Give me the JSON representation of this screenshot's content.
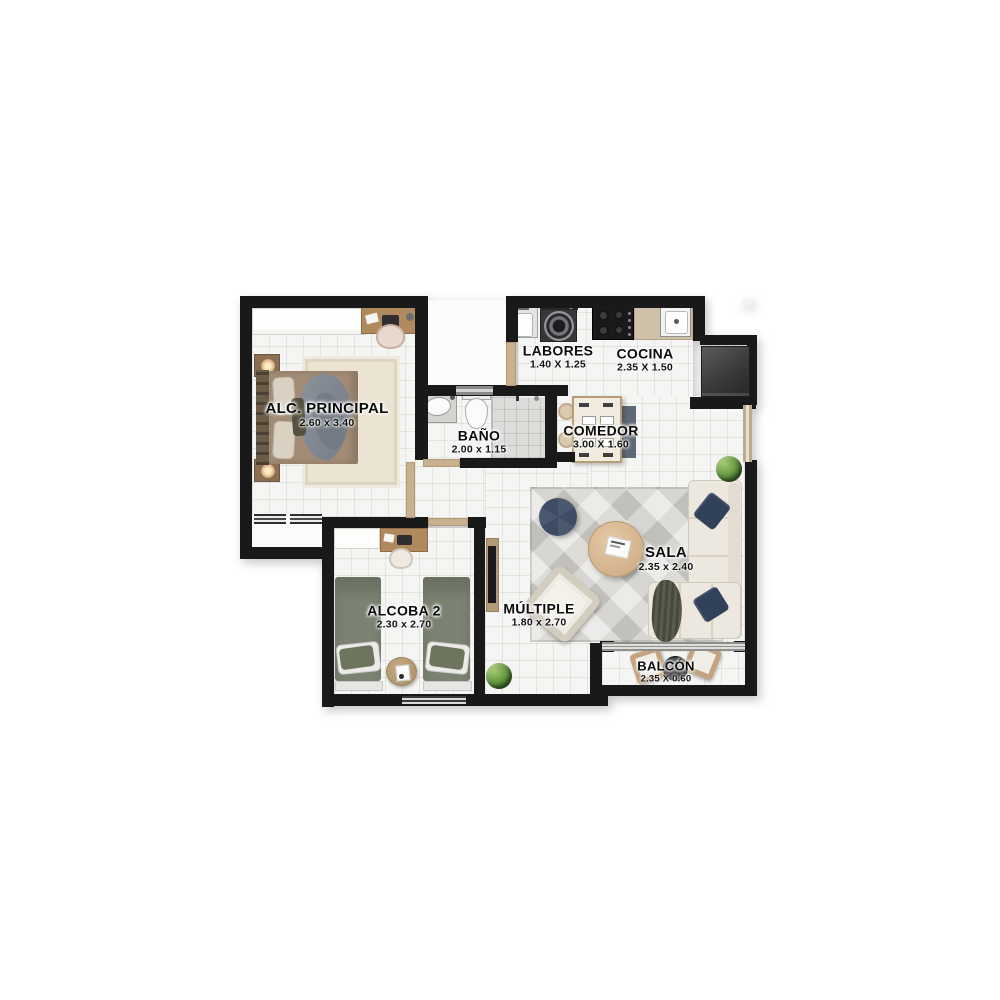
{
  "rooms": [
    {
      "id": "alc_principal",
      "name": "ALC. PRINCIPAL",
      "dims": "2.60 x 3.40"
    },
    {
      "id": "bano",
      "name": "BAÑO",
      "dims": "2.00 x 1.15"
    },
    {
      "id": "labores",
      "name": "LABORES",
      "dims": "1.40 X 1.25"
    },
    {
      "id": "cocina",
      "name": "COCINA",
      "dims": "2.35 X 1.50"
    },
    {
      "id": "comedor",
      "name": "COMEDOR",
      "dims": "3.00 X 1.60"
    },
    {
      "id": "sala",
      "name": "SALA",
      "dims": "2.35 x 2.40"
    },
    {
      "id": "alcoba2",
      "name": "ALCOBA 2",
      "dims": "2.30 x 2.70"
    },
    {
      "id": "multiple",
      "name": "MÚLTIPLE",
      "dims": "1.80 x 2.70"
    },
    {
      "id": "balcon",
      "name": "BALCÓN",
      "dims": "2.35 X 0.60"
    }
  ],
  "colors": {
    "wall": "#191919",
    "floor": "#f5f5f3",
    "door_wood": "#c8b191",
    "furniture_wood": "#b08a5e",
    "bed_green": "#7b8271",
    "bed_taupe": "#a28c76",
    "pillow_navy": "#32415a",
    "sofa_cream": "#ece8df",
    "rug_gray": "#d7d5d0",
    "rug_beige": "#ece4d3",
    "plant_green": "#699a43",
    "appliance_dark": "#2e2e30"
  }
}
